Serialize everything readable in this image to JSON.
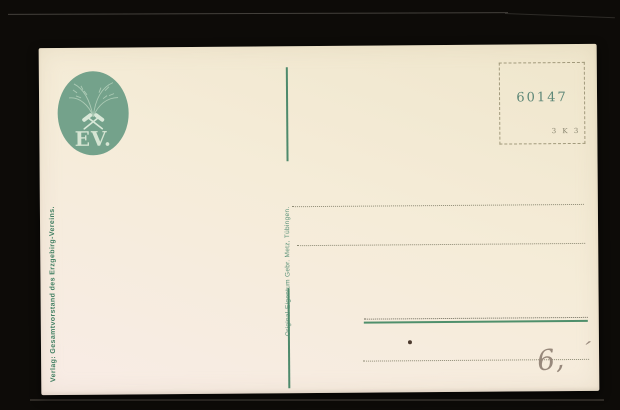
{
  "postcard": {
    "logo": {
      "initials": "EV."
    },
    "publisher_vertical_text": "Verlag: Gesamtvorstand des Erzgebirg-Vereins.",
    "printer_vertical_text": "Original-Eigentum Gebr. Metz, Tübingen.",
    "stamp_box": {
      "number": "60147",
      "code": "3 K 3"
    },
    "handwriting": {
      "figure": "6,",
      "tick": "′"
    },
    "colors": {
      "card_top": "#efe6cc",
      "card_bottom": "#f8ece6",
      "logo_green": "#74a28b",
      "print_green": "#4e8a6c",
      "dotted_gray": "#8d8a74",
      "stamp_ink": "#5d8777"
    }
  }
}
